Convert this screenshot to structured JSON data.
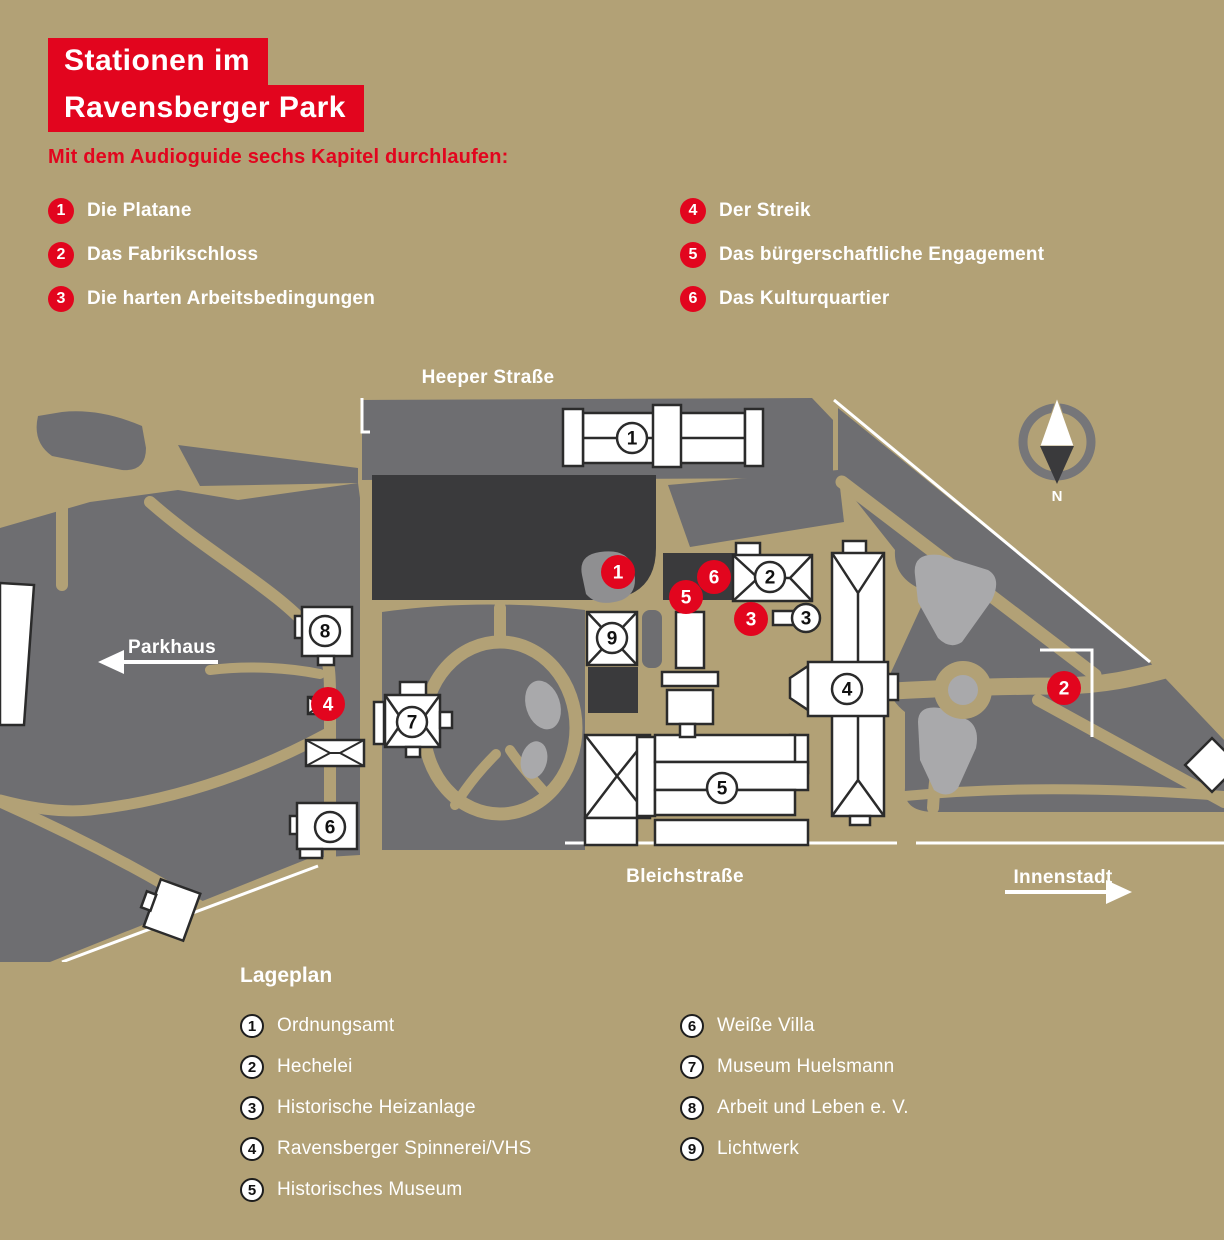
{
  "title": {
    "line1": "Stationen im",
    "line2": "Ravensberger Park"
  },
  "subtitle": "Mit dem Audioguide sechs Kapitel durchlaufen:",
  "audioguide": {
    "items": [
      {
        "num": "1",
        "label": "Die Platane"
      },
      {
        "num": "2",
        "label": "Das Fabrikschloss"
      },
      {
        "num": "3",
        "label": "Die harten Arbeitsbedingungen"
      },
      {
        "num": "4",
        "label": "Der Streik"
      },
      {
        "num": "5",
        "label": "Das bürgerschaftliche Engagement"
      },
      {
        "num": "6",
        "label": "Das Kulturquartier"
      }
    ]
  },
  "map": {
    "street_top": "Heeper Straße",
    "street_bottom": "Bleichstraße",
    "direction_left": "Parkhaus",
    "direction_right": "Innenstadt",
    "compass_label": "N",
    "stations": [
      {
        "num": "1"
      },
      {
        "num": "2"
      },
      {
        "num": "3"
      },
      {
        "num": "4"
      },
      {
        "num": "5"
      },
      {
        "num": "6"
      }
    ],
    "buildings": [
      {
        "num": "1"
      },
      {
        "num": "2"
      },
      {
        "num": "3"
      },
      {
        "num": "4"
      },
      {
        "num": "5"
      },
      {
        "num": "6"
      },
      {
        "num": "7"
      },
      {
        "num": "8"
      },
      {
        "num": "9"
      }
    ]
  },
  "legend": {
    "heading": "Lageplan",
    "items": [
      {
        "num": "1",
        "label": "Ordnungsamt"
      },
      {
        "num": "2",
        "label": "Hechelei"
      },
      {
        "num": "3",
        "label": "Historische Heizanlage"
      },
      {
        "num": "4",
        "label": "Ravensberger Spinnerei/VHS"
      },
      {
        "num": "5",
        "label": "Historisches Museum"
      },
      {
        "num": "6",
        "label": "Weiße Villa"
      },
      {
        "num": "7",
        "label": "Museum Huelsmann"
      },
      {
        "num": "8",
        "label": "Arbeit und Leben e. V."
      },
      {
        "num": "9",
        "label": "Lichtwerk"
      }
    ]
  },
  "colors": {
    "accent_red": "#e2051e",
    "background_tan": "#b2a176",
    "park_gray": "#6e6e71",
    "light_gray": "#a9a9ab",
    "dark_gray": "#3a3a3c"
  }
}
